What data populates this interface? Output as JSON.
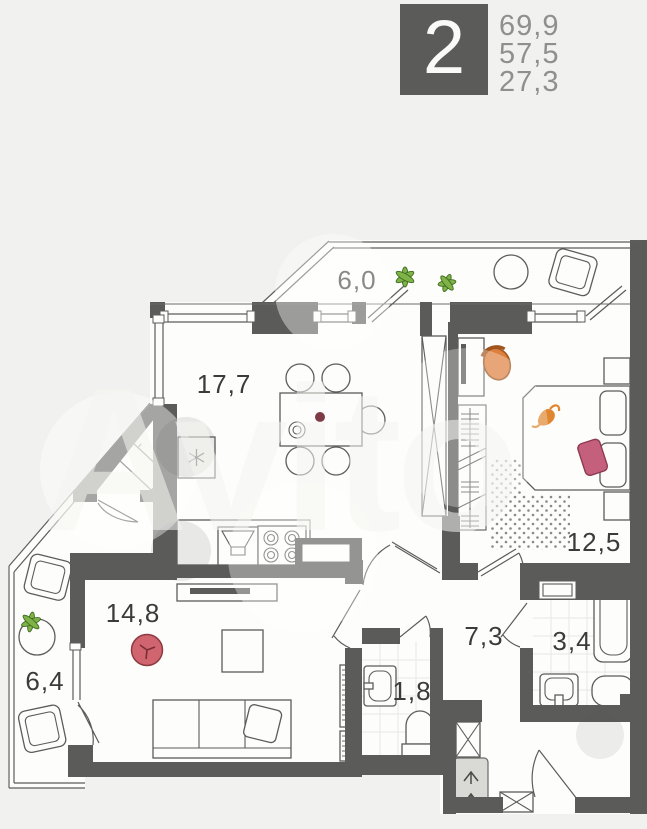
{
  "header": {
    "room_count": "2",
    "areas": [
      "69,9",
      "57,5",
      "27,3"
    ]
  },
  "watermark": {
    "text": "Avito"
  },
  "rooms": {
    "balcony_top": {
      "area": "6,0"
    },
    "kitchen_living": {
      "area": "17,7"
    },
    "bedroom": {
      "area": "12,5"
    },
    "living": {
      "area": "14,8"
    },
    "balcony_side": {
      "area": "6,4"
    },
    "hall": {
      "area": "7,3"
    },
    "bath": {
      "area": "3,4"
    },
    "wc": {
      "area": "1,8"
    }
  },
  "colors": {
    "wall": "#5b5b59",
    "background": "#f1f1ef",
    "floor": "#fdfdfb",
    "pouf_red": "#d06570",
    "chair_orange": "#dd7f3e",
    "pillow_pink": "#c5607c",
    "cat_orange": "#e0862f",
    "plant_green": "#7fb347"
  }
}
